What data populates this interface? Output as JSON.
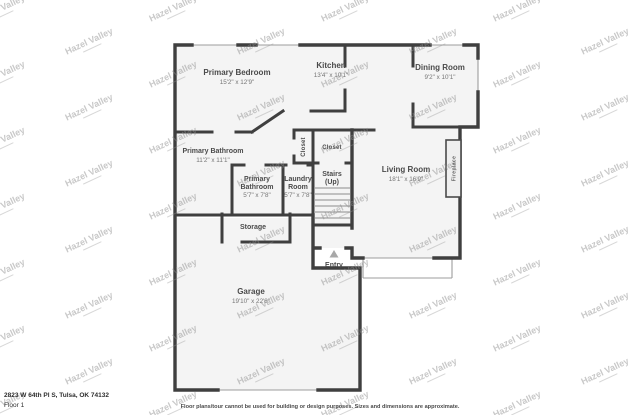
{
  "watermark": {
    "text": "Hazel Valley"
  },
  "footer": {
    "address": "2823 W 64th Pl S, Tulsa, OK 74132",
    "floor_label": "Floor 1",
    "disclaimer": "Floor plans/tour cannot be used for building or design purposes. Sizes and dimensions are approximate."
  },
  "rooms": {
    "primary_bedroom": {
      "name": "Primary Bedroom",
      "dims": "15'2\" x 12'9\""
    },
    "kitchen": {
      "name": "Kitchen",
      "dims": "13'4\" x 10'1\""
    },
    "dining_room": {
      "name": "Dining Room",
      "dims": "9'2\" x 10'1\""
    },
    "primary_bathroom_large": {
      "name": "Primary Bathroom",
      "dims": "11'2\" x 11'1\""
    },
    "primary_bathroom_small": {
      "line1": "Primary",
      "line2": "Bathroom",
      "dims": "5'7\" x 7'8\""
    },
    "laundry_room": {
      "line1": "Laundry",
      "line2": "Room",
      "dims": "5'7\" x 7'8\""
    },
    "stairs": {
      "name": "Stairs",
      "sub": "(Up)"
    },
    "living_room": {
      "name": "Living Room",
      "dims": "18'1\" x 16'9\""
    },
    "closet_left": {
      "name": "Closet"
    },
    "closet_right": {
      "name": "Closet"
    },
    "storage": {
      "name": "Storage"
    },
    "entry": {
      "name": "Entry"
    },
    "garage": {
      "name": "Garage",
      "dims": "19'10\" x 22'8\""
    },
    "fireplace": {
      "name": "Fireplace"
    }
  },
  "colors": {
    "wall": "#3f3f3f",
    "floor_fill": "#f4f4f4",
    "thin_line": "#9d9d9d",
    "watermark": "#8c8c8c",
    "label_text": "#4a4a4a",
    "dims_text": "#757575"
  }
}
